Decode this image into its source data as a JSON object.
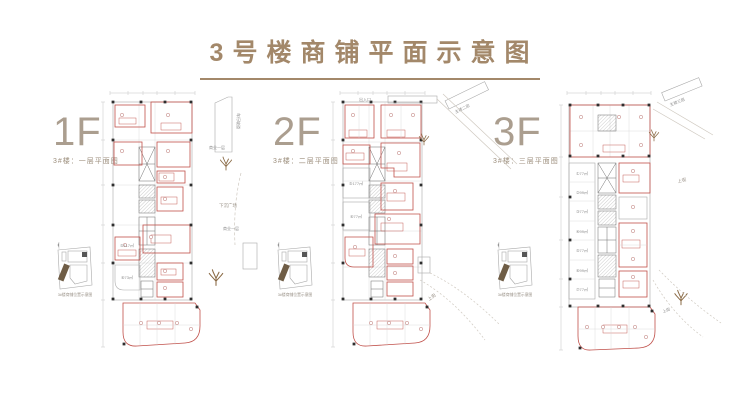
{
  "title": "3号楼商铺平面示意图",
  "floors": [
    {
      "id": "1F",
      "label": "1F",
      "sublabel": "3#楼：一层平面图",
      "keymap_caption": "3#楼商铺位置示意图",
      "units": [
        "⑤117㎡",
        "⑥73㎡"
      ]
    },
    {
      "id": "2F",
      "label": "2F",
      "sublabel": "3#楼：二层平面图",
      "keymap_caption": "3#楼商铺位置示意图",
      "units": [
        "⑤177㎡",
        "⑥77㎡"
      ]
    },
    {
      "id": "3F",
      "label": "3F",
      "sublabel": "3#楼：三层平面图",
      "keymap_caption": "3#楼商铺位置示意图",
      "units": [
        "①77㎡",
        "②99㎡",
        "③77㎡",
        "④99㎡",
        "⑤77㎡",
        "⑥99㎡",
        "⑦77㎡"
      ]
    }
  ],
  "annotations": {
    "ramp": "车行坡道",
    "biz_level": "商业一层",
    "plaza": "下沉广场",
    "entrance": "出入口",
    "tower2": "主楼二层",
    "tower3": "主楼三层",
    "street": "上街"
  },
  "colors": {
    "title_brown": "#a3886a",
    "floor_label_taupe": "#ab9e8f",
    "shop_outline_red": "#c0504a",
    "keymap_highlight_brown": "#6f5d46",
    "tree_brown": "#8a6a45"
  }
}
